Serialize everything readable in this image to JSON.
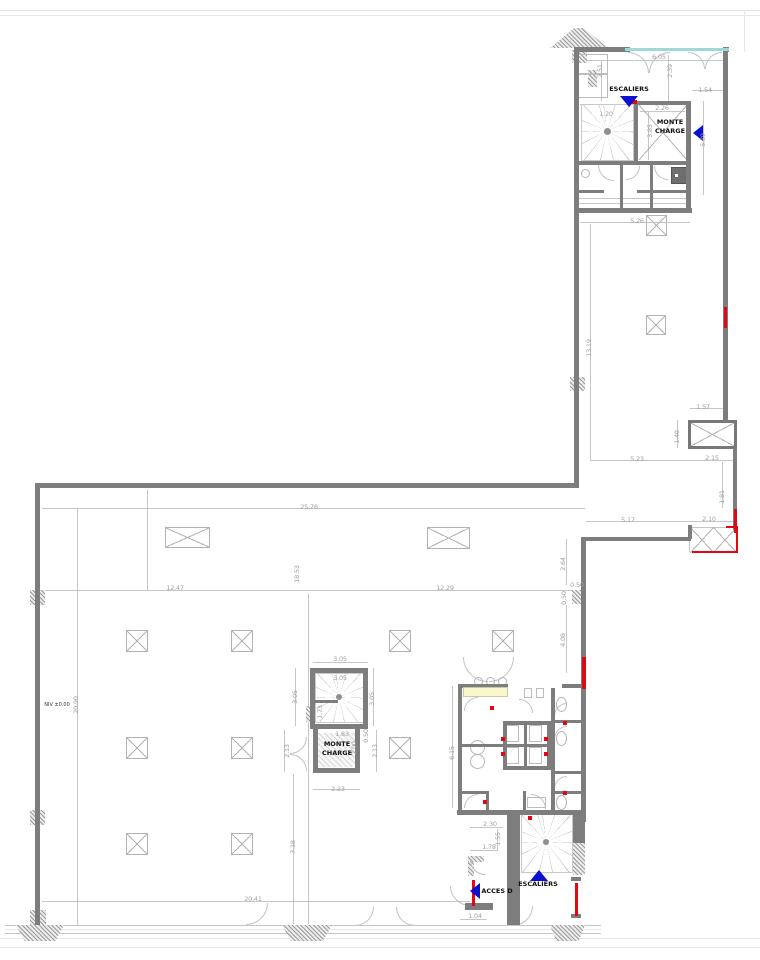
{
  "plan": {
    "colors": {
      "wall": "#7d7d7d",
      "accent_red": "#e30613",
      "marker_blue": "#0a10d0",
      "window_glass": "#9fd8d8",
      "counter_yellow": "#fbf7cd",
      "dim_text": "#9f9f9f"
    },
    "walls": [
      [
        574,
        47,
        56,
        5
      ],
      [
        723,
        47,
        6,
        5
      ],
      [
        574,
        47,
        5,
        165
      ],
      [
        723,
        52,
        5,
        370
      ],
      [
        634,
        101,
        57,
        4
      ],
      [
        634,
        101,
        4,
        63
      ],
      [
        686,
        101,
        5,
        111
      ],
      [
        578,
        161,
        112,
        4
      ],
      [
        578,
        190,
        26,
        3
      ],
      [
        637,
        190,
        53,
        3
      ],
      [
        578,
        208,
        114,
        5
      ],
      [
        620,
        165,
        3,
        43
      ],
      [
        650,
        165,
        3,
        43
      ],
      [
        574,
        212,
        5,
        276
      ],
      [
        35,
        483,
        544,
        5
      ],
      [
        35,
        488,
        5,
        437
      ],
      [
        585,
        537,
        106,
        4
      ],
      [
        581,
        537,
        5,
        285
      ],
      [
        733,
        448,
        4,
        82
      ],
      [
        688,
        525,
        4,
        14
      ],
      [
        507,
        815,
        13,
        110
      ],
      [
        573,
        811,
        12,
        32
      ],
      [
        571,
        877,
        10,
        4
      ],
      [
        571,
        914,
        10,
        4
      ],
      [
        459,
        684,
        49,
        4
      ],
      [
        562,
        684,
        21,
        4
      ],
      [
        458,
        684,
        4,
        128
      ],
      [
        503,
        721,
        48,
        4
      ],
      [
        503,
        766,
        48,
        4
      ],
      [
        503,
        721,
        4,
        49
      ],
      [
        547,
        721,
        4,
        49
      ],
      [
        524,
        721,
        3,
        49
      ],
      [
        503,
        744,
        48,
        3
      ],
      [
        551,
        688,
        4,
        124
      ],
      [
        551,
        720,
        32,
        3
      ],
      [
        551,
        771,
        32,
        3
      ],
      [
        551,
        791,
        32,
        3
      ],
      [
        459,
        744,
        44,
        3
      ],
      [
        459,
        791,
        30,
        3
      ],
      [
        486,
        791,
        3,
        21
      ],
      [
        523,
        791,
        3,
        21
      ],
      [
        457,
        810,
        128,
        5
      ],
      [
        310,
        668,
        58,
        5
      ],
      [
        310,
        668,
        5,
        57
      ],
      [
        363,
        668,
        5,
        57
      ],
      [
        310,
        724,
        58,
        5
      ],
      [
        315,
        700,
        23,
        3
      ],
      [
        313,
        768,
        47,
        5
      ],
      [
        313,
        728,
        5,
        45
      ],
      [
        355,
        728,
        5,
        45
      ],
      [
        465,
        903,
        28,
        7
      ]
    ],
    "red": [
      [
        724,
        307,
        3,
        21
      ],
      [
        734,
        509,
        3,
        24
      ],
      [
        736,
        527,
        2,
        26
      ],
      [
        692,
        551,
        46,
        2
      ],
      [
        726,
        526,
        12,
        2
      ],
      [
        582,
        657,
        4,
        32
      ],
      [
        575,
        883,
        3,
        33
      ],
      [
        472,
        880,
        3,
        26
      ],
      [
        631,
        100,
        6,
        4
      ]
    ],
    "window": [
      [
        625,
        48,
        104,
        3
      ]
    ],
    "counter": [
      [
        463,
        687,
        45,
        10
      ]
    ],
    "lines": [
      [
        42,
        508,
        543,
        1
      ],
      [
        42,
        590,
        543,
        1
      ],
      [
        77,
        508,
        1,
        417
      ],
      [
        42,
        901,
        428,
        1
      ],
      [
        580,
        222,
        110,
        1
      ],
      [
        590,
        224,
        1,
        236
      ],
      [
        590,
        460,
        146,
        1
      ],
      [
        690,
        408,
        37,
        1
      ],
      [
        677,
        420,
        1,
        28
      ],
      [
        722,
        462,
        1,
        46
      ],
      [
        586,
        521,
        151,
        1
      ],
      [
        566,
        539,
        1,
        46
      ],
      [
        566,
        605,
        1,
        68
      ],
      [
        580,
        60,
        147,
        1
      ],
      [
        601,
        60,
        1,
        41
      ],
      [
        668,
        55,
        1,
        46
      ],
      [
        692,
        90,
        35,
        1
      ],
      [
        640,
        111,
        45,
        1
      ],
      [
        648,
        111,
        1,
        49
      ],
      [
        703,
        101,
        1,
        94
      ],
      [
        313,
        662,
        55,
        1
      ],
      [
        295,
        668,
        1,
        58
      ],
      [
        373,
        668,
        1,
        58
      ],
      [
        313,
        789,
        47,
        1
      ],
      [
        284,
        730,
        1,
        42
      ],
      [
        376,
        730,
        1,
        42
      ],
      [
        452,
        686,
        1,
        122
      ],
      [
        293,
        774,
        1,
        150
      ],
      [
        470,
        827,
        33,
        1
      ],
      [
        470,
        850,
        28,
        1
      ],
      [
        460,
        919,
        27,
        1
      ],
      [
        497,
        829,
        1,
        21
      ],
      [
        147,
        490,
        1,
        100
      ],
      [
        308,
        594,
        1,
        330
      ],
      [
        580,
        104,
        54,
        1
      ],
      [
        578,
        198,
        113,
        1
      ],
      [
        578,
        203,
        113,
        1
      ],
      [
        690,
        527,
        47,
        1
      ],
      [
        689,
        527,
        1,
        25
      ],
      [
        5,
        925,
        596,
        1
      ],
      [
        5,
        933,
        596,
        1
      ]
    ],
    "faint": [
      [
        0,
        10,
        760,
        1
      ],
      [
        0,
        15,
        760,
        1
      ],
      [
        0,
        938,
        760,
        1
      ],
      [
        0,
        947,
        760,
        1
      ],
      [
        744,
        10,
        1,
        42
      ],
      [
        5,
        929,
        596,
        1
      ]
    ],
    "hatch": [
      [
        572,
        50,
        15,
        13,
        ""
      ],
      [
        588,
        70,
        9,
        17,
        ""
      ],
      [
        570,
        377,
        15,
        14,
        ""
      ],
      [
        30,
        590,
        15,
        15,
        ""
      ],
      [
        30,
        810,
        15,
        15,
        ""
      ],
      [
        30,
        910,
        16,
        15,
        ""
      ],
      [
        572,
        590,
        14,
        14,
        ""
      ],
      [
        573,
        843,
        12,
        32,
        ""
      ],
      [
        468,
        856,
        6,
        20,
        ""
      ],
      [
        468,
        856,
        16,
        6,
        ""
      ],
      [
        306,
        706,
        9,
        16,
        ""
      ],
      [
        16,
        925,
        48,
        16,
        "trap"
      ],
      [
        282,
        925,
        50,
        16,
        "trap"
      ],
      [
        550,
        925,
        35,
        16,
        "trap"
      ],
      [
        550,
        28,
        58,
        20,
        "roof"
      ]
    ],
    "hatch_light": [
      [
        318,
        733,
        37,
        34
      ]
    ],
    "columns": [
      [
        165,
        527,
        45,
        21
      ],
      [
        427,
        527,
        43,
        22
      ],
      [
        126,
        630,
        22,
        22
      ],
      [
        231,
        630,
        22,
        22
      ],
      [
        389,
        630,
        22,
        22
      ],
      [
        492,
        630,
        22,
        22
      ],
      [
        126,
        737,
        22,
        22
      ],
      [
        231,
        737,
        22,
        22
      ],
      [
        389,
        737,
        22,
        22
      ],
      [
        126,
        833,
        22,
        22
      ],
      [
        231,
        833,
        22,
        22
      ],
      [
        646,
        215,
        21,
        21
      ],
      [
        646,
        315,
        20,
        20
      ]
    ],
    "crosses": [
      [
        690,
        527,
        24,
        26
      ],
      [
        713,
        527,
        24,
        26
      ],
      [
        639,
        105,
        48,
        55
      ]
    ],
    "shaft": [
      [
        688,
        420,
        49,
        29
      ]
    ],
    "arcs": [
      [
        628,
        52,
        21,
        21,
        "tr"
      ],
      [
        649,
        52,
        21,
        21,
        "tl"
      ],
      [
        688,
        52,
        17,
        17,
        "tr"
      ],
      [
        705,
        52,
        17,
        17,
        "tl"
      ],
      [
        598,
        165,
        16,
        16,
        "bl"
      ],
      [
        626,
        166,
        14,
        14,
        "br"
      ],
      [
        654,
        166,
        14,
        14,
        "bl"
      ],
      [
        246,
        903,
        22,
        22,
        "br"
      ],
      [
        355,
        907,
        19,
        19,
        "br"
      ],
      [
        396,
        907,
        19,
        19,
        "bl"
      ],
      [
        513,
        906,
        20,
        20,
        "br"
      ],
      [
        450,
        886,
        20,
        20,
        "bl"
      ],
      [
        290,
        737,
        17,
        17,
        "br"
      ],
      [
        290,
        754,
        17,
        17,
        "tr"
      ],
      [
        463,
        657,
        25,
        25,
        "bl"
      ],
      [
        489,
        657,
        25,
        25,
        "br"
      ],
      [
        464,
        697,
        14,
        14,
        "tl"
      ],
      [
        519,
        699,
        14,
        14,
        "tr"
      ],
      [
        554,
        703,
        13,
        13,
        "tl"
      ],
      [
        554,
        726,
        13,
        13,
        "tl"
      ],
      [
        554,
        776,
        13,
        13,
        "tl"
      ],
      [
        464,
        794,
        14,
        14,
        "tl"
      ],
      [
        531,
        794,
        15,
        15,
        "tr"
      ],
      [
        470,
        860,
        15,
        15,
        "bl"
      ]
    ],
    "circles": [
      [
        474,
        677,
        9
      ],
      [
        486,
        677,
        9
      ],
      [
        498,
        677,
        9
      ],
      [
        470,
        740,
        15
      ],
      [
        470,
        754,
        15
      ],
      [
        581,
        169,
        9
      ]
    ],
    "ellipses": [
      [
        556,
        697,
        11,
        15
      ],
      [
        556,
        731,
        11,
        15
      ],
      [
        556,
        795,
        11,
        15
      ]
    ],
    "fixtures": [
      [
        506,
        725,
        13,
        17
      ],
      [
        529,
        725,
        13,
        17
      ],
      [
        506,
        747,
        13,
        17
      ],
      [
        529,
        747,
        13,
        17
      ],
      [
        527,
        797,
        19,
        11
      ],
      [
        524,
        688,
        8,
        10
      ],
      [
        536,
        688,
        8,
        10
      ],
      [
        578,
        54,
        30,
        20
      ],
      [
        578,
        74,
        30,
        24
      ]
    ],
    "shower": [
      [
        671,
        167,
        17,
        17
      ]
    ],
    "spirals": [
      [
        581,
        104,
        53,
        57,
        49,
        47
      ],
      [
        315,
        673,
        49,
        50,
        49,
        48
      ],
      [
        521,
        813,
        52,
        60,
        48,
        48
      ]
    ],
    "hubs": [
      [
        604,
        128,
        7
      ],
      [
        336,
        694,
        6
      ],
      [
        543,
        839,
        6
      ]
    ],
    "markers": [
      [
        490,
        706
      ],
      [
        501,
        737
      ],
      [
        544,
        737
      ],
      [
        501,
        752
      ],
      [
        544,
        752
      ],
      [
        563,
        721
      ],
      [
        563,
        791
      ],
      [
        483,
        800
      ],
      [
        528,
        816
      ]
    ],
    "triangles": [
      {
        "x": 620,
        "y": 96,
        "dir": "down",
        "name": "stairs-up-arrow"
      },
      {
        "x": 693,
        "y": 125,
        "dir": "left",
        "name": "monte-charge-arrow"
      },
      {
        "x": 530,
        "y": 870,
        "dir": "up",
        "name": "stairs-down-arrow"
      },
      {
        "x": 470,
        "y": 883,
        "dir": "left",
        "name": "access-d-arrow"
      }
    ],
    "dims": [
      {
        "t": "6.05",
        "x": 659,
        "y": 57
      },
      {
        "t": "2.51",
        "x": 600,
        "y": 71,
        "r": 1
      },
      {
        "t": "2.39",
        "x": 670,
        "y": 71,
        "r": 1
      },
      {
        "t": "1.54",
        "x": 705,
        "y": 90
      },
      {
        "t": "2.26",
        "x": 662,
        "y": 108
      },
      {
        "t": "1.20",
        "x": 606,
        "y": 114
      },
      {
        "t": "3.85",
        "x": 650,
        "y": 131,
        "r": 1
      },
      {
        "t": "5.39",
        "x": 703,
        "y": 140,
        "r": 1
      },
      {
        "t": "5.26",
        "x": 637,
        "y": 221
      },
      {
        "t": "13.19",
        "x": 589,
        "y": 348,
        "r": 1
      },
      {
        "t": "1.57",
        "x": 703,
        "y": 407
      },
      {
        "t": "1.40",
        "x": 677,
        "y": 437,
        "r": 1
      },
      {
        "t": "5.23",
        "x": 637,
        "y": 459
      },
      {
        "t": "2.15",
        "x": 712,
        "y": 458
      },
      {
        "t": "1.81",
        "x": 722,
        "y": 497,
        "r": 1
      },
      {
        "t": "5.17",
        "x": 628,
        "y": 520
      },
      {
        "t": "2.10",
        "x": 709,
        "y": 519
      },
      {
        "t": "2.64",
        "x": 563,
        "y": 564,
        "r": 1
      },
      {
        "t": "0.50",
        "x": 577,
        "y": 585
      },
      {
        "t": "0.50",
        "x": 564,
        "y": 598,
        "r": 1
      },
      {
        "t": "4.08",
        "x": 563,
        "y": 640,
        "r": 1
      },
      {
        "t": "25.76",
        "x": 309,
        "y": 507
      },
      {
        "t": "12.47",
        "x": 175,
        "y": 588
      },
      {
        "t": "18.53",
        "x": 297,
        "y": 574,
        "r": 1
      },
      {
        "t": "12.29",
        "x": 445,
        "y": 588
      },
      {
        "t": "20.90",
        "x": 76,
        "y": 705,
        "r": 1
      },
      {
        "t": "3.05",
        "x": 340,
        "y": 659
      },
      {
        "t": "3.05",
        "x": 340,
        "y": 678
      },
      {
        "t": "3.05",
        "x": 295,
        "y": 697,
        "r": 1
      },
      {
        "t": "3.05",
        "x": 372,
        "y": 699,
        "r": 1
      },
      {
        "t": "1.73",
        "x": 320,
        "y": 712,
        "r": 1
      },
      {
        "t": "1.83",
        "x": 342,
        "y": 734
      },
      {
        "t": "2.00",
        "x": 354,
        "y": 748,
        "r": 1
      },
      {
        "t": "0.50",
        "x": 366,
        "y": 736,
        "r": 1
      },
      {
        "t": "2.13",
        "x": 287,
        "y": 751,
        "r": 1
      },
      {
        "t": "2.13",
        "x": 375,
        "y": 751,
        "r": 1
      },
      {
        "t": "2.23",
        "x": 338,
        "y": 789
      },
      {
        "t": "6.15",
        "x": 452,
        "y": 753,
        "r": 1
      },
      {
        "t": "7.18",
        "x": 293,
        "y": 847,
        "r": 1
      },
      {
        "t": "2.30",
        "x": 490,
        "y": 824
      },
      {
        "t": "1.55",
        "x": 498,
        "y": 839,
        "r": 1
      },
      {
        "t": "1.78",
        "x": 489,
        "y": 847
      },
      {
        "t": "1.04",
        "x": 475,
        "y": 916
      },
      {
        "t": "20.41",
        "x": 253,
        "y": 899
      }
    ],
    "labels": [
      {
        "t": "ESCALIERS",
        "x": 629,
        "y": 89,
        "name": "label-escaliers-top"
      },
      {
        "t": "MONTE",
        "x": 670,
        "y": 122,
        "name": "label-monte-charge-top"
      },
      {
        "t": "CHARGE",
        "x": 670,
        "y": 131,
        "name": "label-monte-charge-top"
      },
      {
        "t": "MONTE",
        "x": 337,
        "y": 744,
        "name": "label-monte-charge-center"
      },
      {
        "t": "CHARGE",
        "x": 337,
        "y": 753,
        "name": "label-monte-charge-center"
      },
      {
        "t": "ESCALIERS",
        "x": 538,
        "y": 884,
        "name": "label-escaliers-bottom"
      },
      {
        "t": "ACCES D",
        "x": 497,
        "y": 891,
        "name": "label-acces-d"
      },
      {
        "t": "NIV ±0.00",
        "x": 57,
        "y": 705,
        "tiny": 1,
        "name": "label-niveau"
      }
    ]
  }
}
